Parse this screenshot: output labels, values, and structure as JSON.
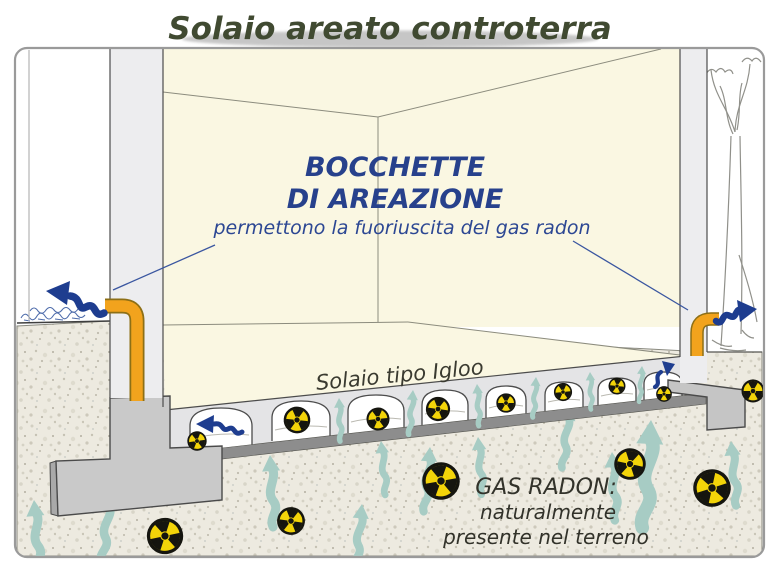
{
  "title": "Solaio areato controterra",
  "vent_callout": {
    "heading_line1": "BOCCHETTE",
    "heading_line2": "DI AREAZIONE",
    "description": "permettono la fuoriuscita del gas radon"
  },
  "slab_label": "Solaio tipo Igloo",
  "radon_callout": {
    "heading": "GAS RADON:",
    "line2": "naturalmente",
    "line3": "presente nel terreno"
  },
  "radiation_symbol_label": "Rn",
  "icons": {
    "radiation": "radiation-trefoil-icon",
    "vent_exhaust": "blue-wavy-arrow-icon",
    "radon_rise": "teal-wavy-arrow-icon"
  },
  "colors": {
    "callout_blue": "#27418c",
    "arrow_blue": "#1e3d8f",
    "pipe_orange": "#f2a31d",
    "radon_flow_teal": "#a7ccc4",
    "radiation_yellow": "#f3d409",
    "title_olive": "#404a31",
    "room_cream": "#faf7e2",
    "soil_beige": "#edeae0",
    "wall_gray": "#ededef",
    "slab_gray": "#e4e4e6",
    "footing_gray": "#c9c9c9",
    "base_strip_gray": "#8d8d8d"
  }
}
